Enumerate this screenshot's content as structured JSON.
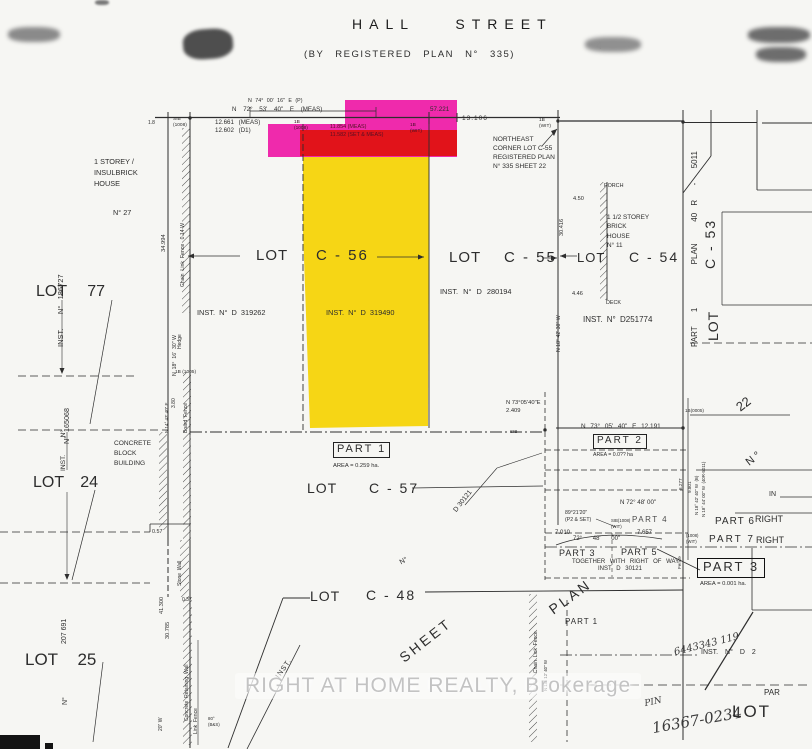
{
  "document": {
    "kind": "Scanned land survey plan"
  },
  "street": {
    "name": "HALL STREET",
    "plan_note": "(BY REGISTERED PLAN N° 335)"
  },
  "watermark": {
    "text": "RIGHT AT HOME REALTY, Brokerage"
  },
  "colors": {
    "highlight_pink": "#ee18a6",
    "highlight_red": "#df1212",
    "highlight_yellow": "#f6d408",
    "line": "#2e2e2e",
    "paper": "#f6f6f3",
    "watermark_gray": "#c3c3c3"
  },
  "labels": {
    "bearing_p": "N 74° 00' 16\" E   (P)",
    "bearing_meas": "N  72°  53'  40\"  E      (MEAS)",
    "dim_57221": "57.221",
    "dim_13106": "13.106",
    "sib_nw": "SIB\n(1008)",
    "dim_12661": "12.661   (MEAS)",
    "dim_12602": "12.602   (D1)",
    "dim_18": "1.8",
    "pk_b1008": "1B\n(1008)",
    "pk_meas": "11.854  (MEAS)",
    "pk_set": "11.582  (SET & MEAS)",
    "pk_wit": "1B\n(WIT)",
    "wit_ne": "1B\n(WIT)",
    "ne_note": "NORTHEAST\nCORNER LOT C-55\nREGISTERED PLAN\nN° 335   SHEET 22",
    "house_left": "1 STOREY /\nINSULBRICK\nHOUSE",
    "house_no27": "N° 27",
    "dim_34994": "34.994",
    "fence_left_upper": "Chain  Link  Fence   0.14 W",
    "hedge": "Hedge",
    "b1005": "1B (1005)",
    "bearing_left1": "N  18°  16'  30\" W",
    "board_fence": "Board  Fence",
    "dim_380": "3.80",
    "bearing_left2": "N 14° 43' 40\" E",
    "lot77": "LOT      77",
    "inst_186727": "INST.       N°   186727",
    "inst_165068": "N°  165068",
    "inst_d319262": "INST.  N°  D  319262",
    "lot_word_a": "LOT",
    "lot_c56": "C - 56",
    "lot_word_b": "LOT",
    "lot_c55": "C - 55",
    "inst_d319490": "INST. N° D 319490",
    "inst_d280194": "INST.    N°   D   280194",
    "lot_word_c": "LOT",
    "lot_c54": "C - 54",
    "porch": "PORCH",
    "dim_450": "4.50",
    "house_right": "1 1/2 STOREY\n BRICK\n HOUSE\n  N° 11",
    "dim_30416": "30.416",
    "dim_446": "4.46",
    "deck": "DECK",
    "inst_d251774": "INST.   N°  D251774",
    "bearing_right1": "N 18° 42' 30\" W",
    "part1_plan_strip": "PART  1      PLAN   40 R  -  5011",
    "lot_c53": "C - 53",
    "lot_word_v": "LOT",
    "num22": "22",
    "part1_box": "PART 1",
    "part1_area": "AREA = 0.259 ha.",
    "lot_word_d": "LOT",
    "lot_c57": "C - 57",
    "d30121_diag": "D 30121",
    "n7305_2409": "N 73°05'40\"E\n    2.409",
    "sib_mid": "SIB",
    "n7305_12191": "N 73° 05' 40\" E     12.191",
    "part2_box": "PART 2",
    "part2_area": "AREA = 0.0?? ha",
    "b0005r": "1B(0005)",
    "no_diag": "N °",
    "bearing_col1": "N 18° 42' 40\" W  (B)",
    "bearing_col2": "N 18° 44' 00\" W  (40R-5011)",
    "dim_9801": "9.801",
    "dim_8277": "8.277",
    "in_right": "IN",
    "n7248": "N 72° 48' 00\"",
    "deg8921": "89°21'20\"\n(P2 & SET)",
    "sib_wit2": "SIB(1008)\n(WIT)",
    "part4": "PART 4",
    "part6": "PART 6",
    "right1": "RIGHT",
    "part7": "PART 7",
    "right2": "RIGHT",
    "wit3": "(1008)\n(WIT)",
    "dim_7010": "7.010",
    "arc_7248": "72°      48'      00\"",
    "dim_7657": "7.657",
    "part3_small": "PART 3",
    "part5": "PART 5",
    "fence_r": "Fence",
    "together": "TOGETHER   WITH   RIGHT   OF   WAY",
    "inst_d30121b": "INST    D 30121",
    "part3_box": "PART 3",
    "part3_area": "AREA = 0.001 ha.",
    "plan_diag": "PLAN",
    "sheet_diag": "SHEET",
    "no_mid": "N°",
    "concrete_bldg": "CONCRETE\nBLOCK\nBUILDING",
    "lot24": "LOT    24",
    "inst_no24": "INST.   N°",
    "dim_057": "0.57",
    "stone_wall": "Stone  Wall",
    "dim_037": "0.37",
    "dim_41300": "41.300",
    "dim_30785": "30.785",
    "v207691": "207 691",
    "lot25": "LOT      25",
    "no25": "N°",
    "retaining_wall": "Concrete  Retaining  Wall",
    "link_fence2": "Link  Fence",
    "v20w": "20\" W",
    "deg80": "80°\n(B&S)",
    "inst_diag": "INST.",
    "lot_word_e": "LOT",
    "lot_c48": "C - 48",
    "clf_bottom": "Chain  Link  Fence",
    "bearing_bottom": "N 18° 12' 40\" W",
    "part1_br": "PART 1",
    "hw1": "6443343  119",
    "inst_d2": "INST.    N°    D 2",
    "hw_pin": "PIN",
    "hw_num": "16367-0234",
    "par_edge": "PAR",
    "lot_br": "LOT",
    "faint4": "4"
  }
}
